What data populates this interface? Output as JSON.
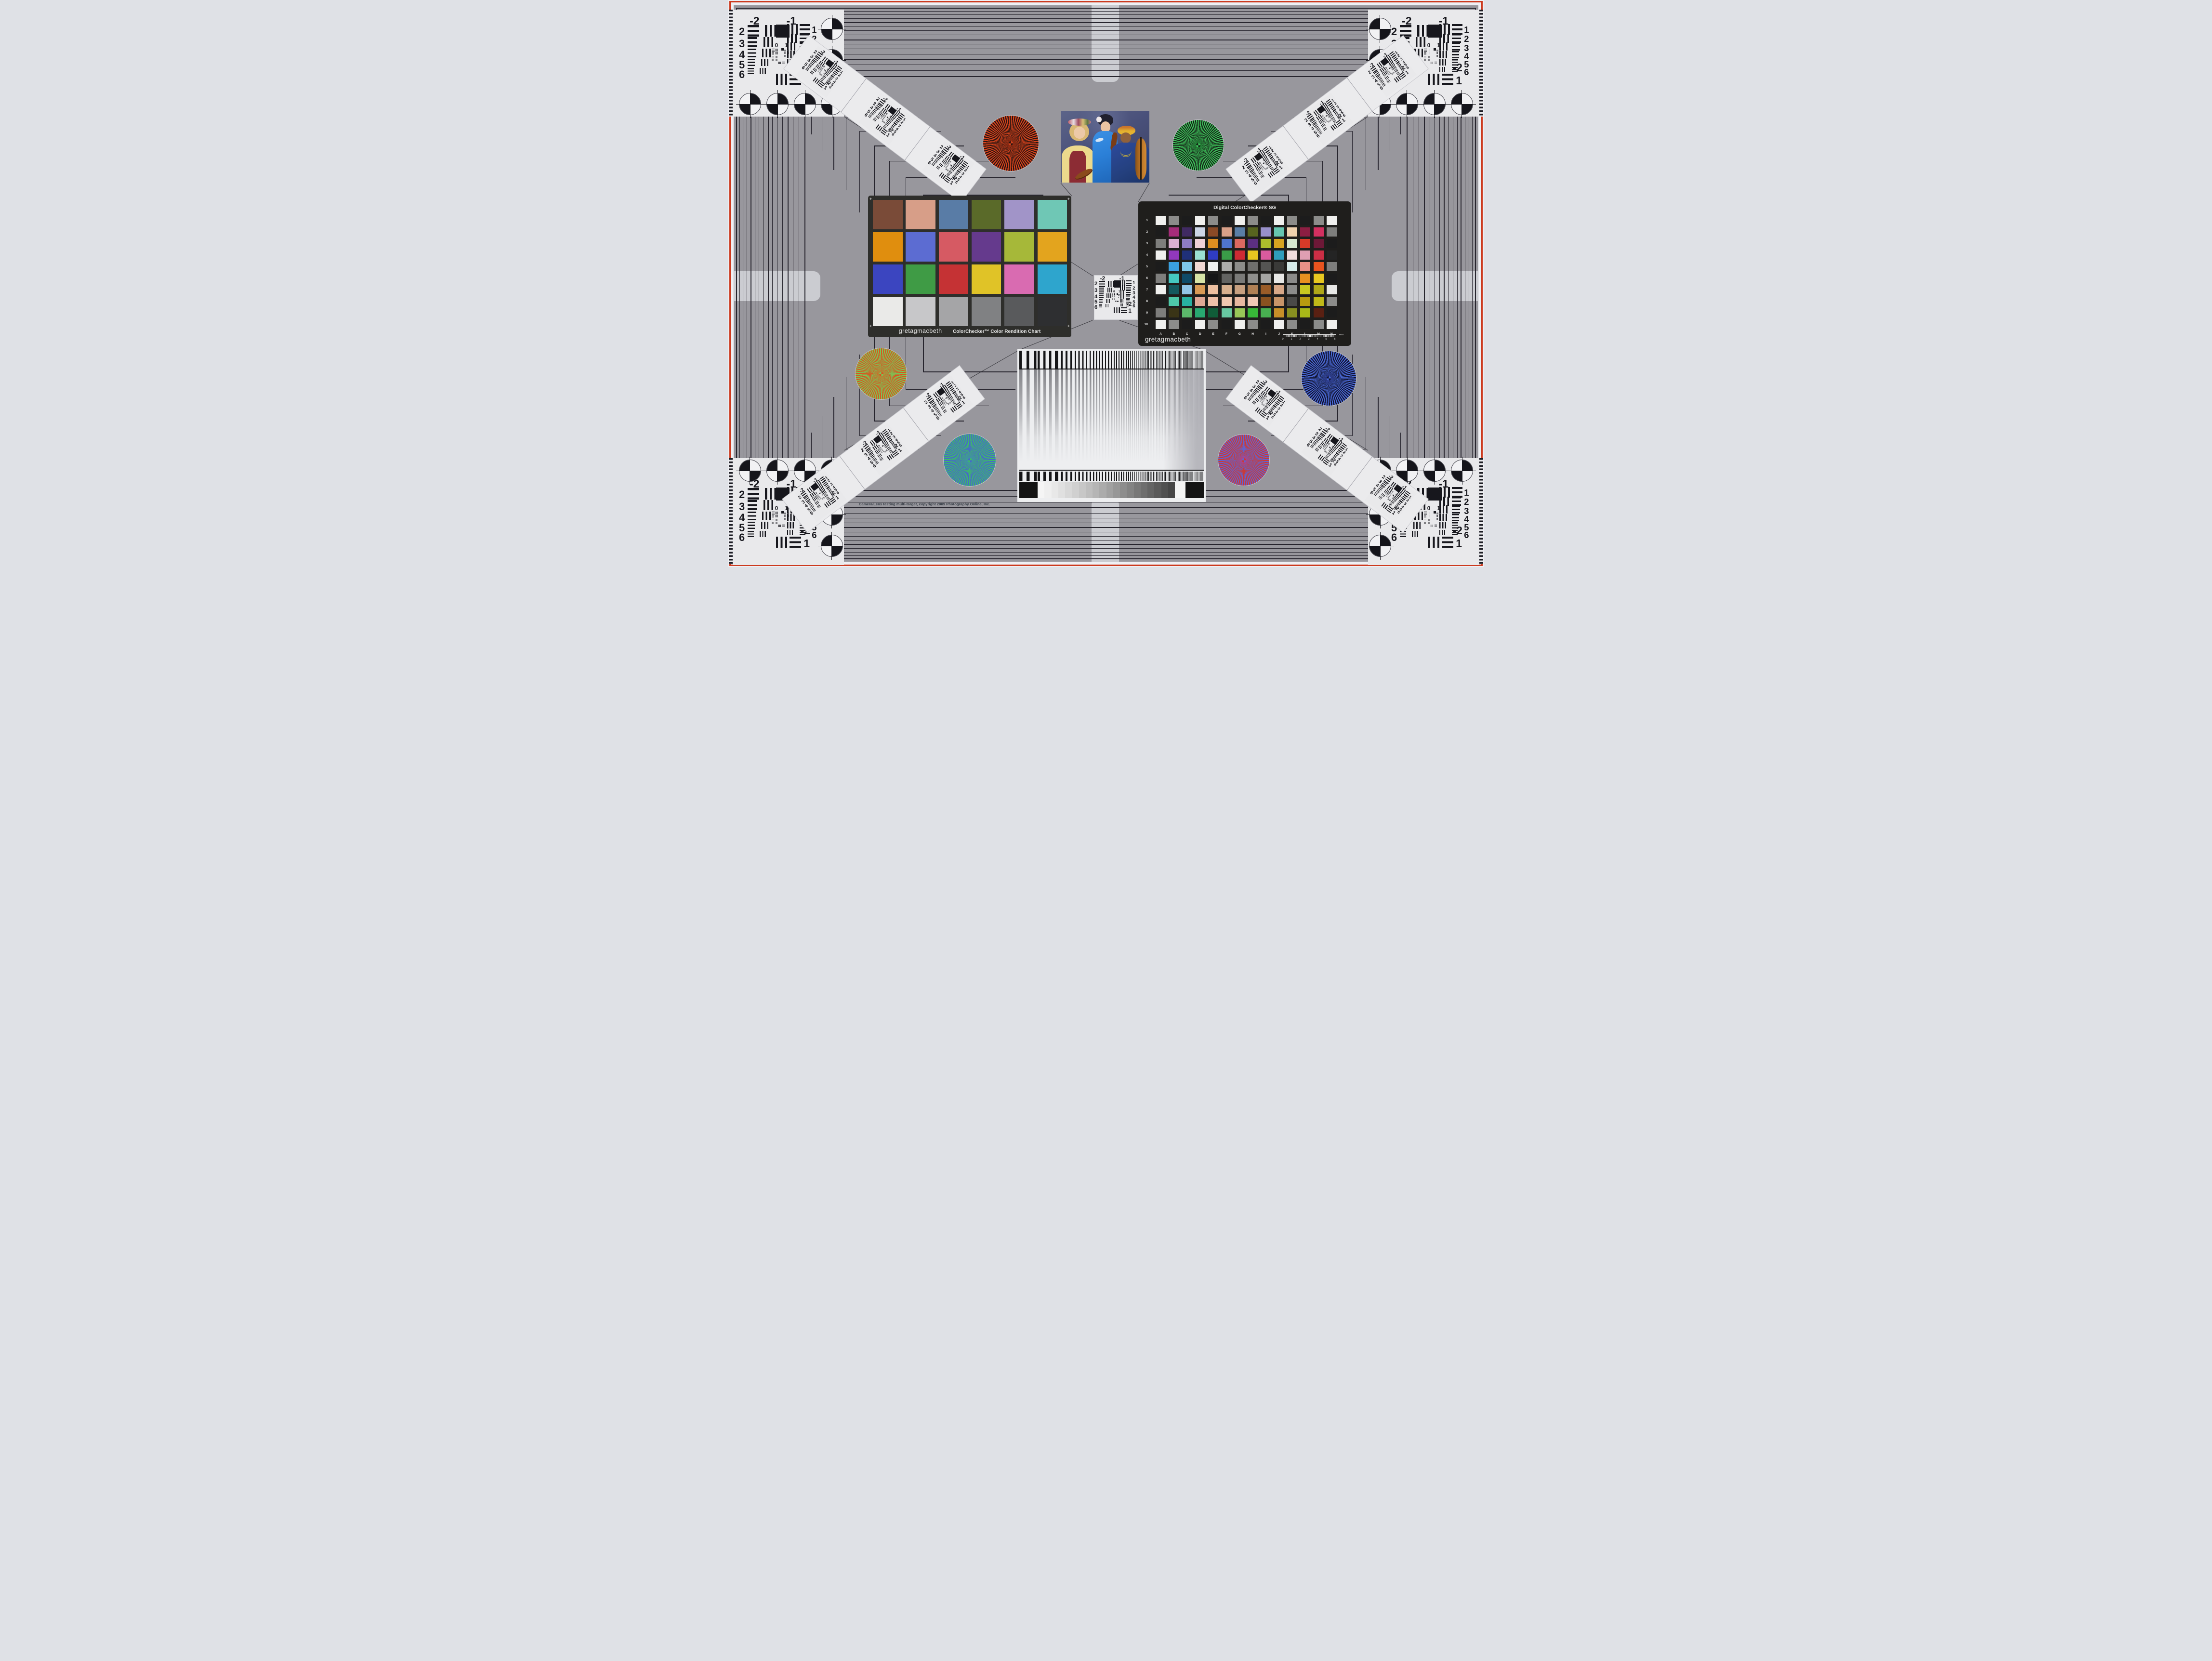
{
  "meta": {
    "copyright": "Camera/Lens testing multi-target, copyright 2009 Photography Online, Inc."
  },
  "frame": {
    "red_border": "#cc3a1f",
    "field_gray": "#98979d",
    "line_color": "#27252e",
    "edge_bar": "#cbccd1",
    "panel_white": "#e9e9eb"
  },
  "usaf": {
    "top_left": "-2",
    "top_right": "-1",
    "left_rows": [
      "2",
      "3",
      "4",
      "5",
      "6"
    ],
    "right_rows": [
      "1",
      "2",
      "3",
      "4",
      "5",
      "6"
    ],
    "bottom_right_top": "-2",
    "bottom_right_bottom": "1",
    "inner": [
      "0",
      "1"
    ]
  },
  "colorchecker": {
    "brand": "gretagmacbeth",
    "title": "ColorChecker™ Color Rendition Chart",
    "corner_mark": "+",
    "patches": [
      "#7a4b38",
      "#d79e88",
      "#597ca6",
      "#5a6a29",
      "#a194c8",
      "#6fc7b5",
      "#e08e0e",
      "#5c6cd2",
      "#d65a63",
      "#653a8d",
      "#a6b839",
      "#e3a41e",
      "#3b45c0",
      "#3f9b45",
      "#c53234",
      "#e0c327",
      "#d96bb1",
      "#2ea5cd",
      "#eaeae8",
      "#c7c7c9",
      "#a5a5a7",
      "#808183",
      "#595a5c",
      "#2e2f31"
    ]
  },
  "sg": {
    "title": "Digital ColorChecker® SG",
    "brand": "gretagmacbeth",
    "row_labels": [
      "1",
      "2",
      "3",
      "4",
      "5",
      "6",
      "7",
      "8",
      "9",
      "10"
    ],
    "col_labels": [
      "A",
      "B",
      "C",
      "D",
      "E",
      "F",
      "G",
      "H",
      "I",
      "J",
      "K",
      "L",
      "M",
      "N"
    ],
    "ruler": {
      "values": [
        "0",
        "1",
        "2",
        "3",
        "4",
        "5",
        "6"
      ],
      "unit": "mm"
    },
    "patches": [
      [
        "#f0f0ee",
        "#8c8c8a",
        "#1c1c1c",
        "#f0f0ee",
        "#8c8c8a",
        "#1c1c1c",
        "#f0f0ee",
        "#8c8c8a",
        "#1c1c1c",
        "#f0f0ee",
        "#8c8c8a",
        "#1c1c1c",
        "#8c8c8a",
        "#f0f0ee"
      ],
      [
        "#1c1c1c",
        "#a62c7a",
        "#402a62",
        "#ccd5e6",
        "#8a4a26",
        "#d8a088",
        "#5a7ea6",
        "#57641f",
        "#9890ca",
        "#66c6b0",
        "#efd2ae",
        "#8c1e42",
        "#d23060",
        "#7e7e7c"
      ],
      [
        "#7e7e7c",
        "#dcb0d2",
        "#8d7cc2",
        "#f0d0d8",
        "#de8f20",
        "#4f74ce",
        "#dc6860",
        "#5c2f80",
        "#adbd2c",
        "#d8a420",
        "#d8e8d0",
        "#d83a28",
        "#6d1837",
        "#1c1c1c"
      ],
      [
        "#f0f0ee",
        "#9238bc",
        "#1f3078",
        "#9adfd2",
        "#2f3cc4",
        "#3a9c48",
        "#ce2b33",
        "#e6c720",
        "#d95b9e",
        "#2f9dbc",
        "#efdcdc",
        "#df9fb2",
        "#cb2e45",
        "#242424"
      ],
      [
        "#1c1c1c",
        "#3aa0e0",
        "#7ec6e8",
        "#f2d8d2",
        "#f0f0ee",
        "#adadab",
        "#8c8c8a",
        "#6f6f6d",
        "#555553",
        "#3a3a38",
        "#d8ecea",
        "#e89086",
        "#e8541f",
        "#7e7e7c"
      ],
      [
        "#7e7e7c",
        "#45c8c0",
        "#0f4a68",
        "#d8e4a6",
        "#161616",
        "#636361",
        "#7a7a78",
        "#8f8f8d",
        "#a5a5a3",
        "#e8e8e6",
        "#8c8c8a",
        "#e89020",
        "#e8c820",
        "#1c1c1c"
      ],
      [
        "#f0f0ee",
        "#14595e",
        "#92c4e6",
        "#d89a55",
        "#eec0a0",
        "#d8b08e",
        "#c8a080",
        "#b08055",
        "#9a5c28",
        "#d8a888",
        "#8c8c8a",
        "#c8c820",
        "#b0a818",
        "#e8e8e6"
      ],
      [
        "#1c1c1c",
        "#4ec8a8",
        "#28b0a0",
        "#e0a896",
        "#eec0a8",
        "#f0c8b0",
        "#e8b8a0",
        "#f0c8b6",
        "#8a5220",
        "#c89468",
        "#4a4a48",
        "#b89a10",
        "#c0b818",
        "#8c8c8a"
      ],
      [
        "#7e7e7c",
        "#3a3416",
        "#5cb86a",
        "#28a870",
        "#105c38",
        "#68c8a0",
        "#98c858",
        "#38b838",
        "#48b050",
        "#c89028",
        "#889020",
        "#a8b818",
        "#5a2012",
        "#1c1c1c"
      ],
      [
        "#f0f0ee",
        "#8c8c8a",
        "#1c1c1c",
        "#f0f0ee",
        "#8c8c8a",
        "#1c1c1c",
        "#f0f0ee",
        "#8c8c8a",
        "#1c1c1c",
        "#f0f0ee",
        "#8c8c8a",
        "#1c1c1c",
        "#8c8c8a",
        "#f0f0ee"
      ]
    ]
  },
  "stars": [
    {
      "name": "star-red-black",
      "a": "#d7431d",
      "b": "#2a1410",
      "center": "#8c2a12"
    },
    {
      "name": "star-green-black",
      "a": "#3fc45c",
      "b": "#132015",
      "center": "#1f7a32"
    },
    {
      "name": "star-red-green",
      "a": "#d85420",
      "b": "#78c858",
      "center": "#b98233"
    },
    {
      "name": "star-blue-black",
      "a": "#4a69d6",
      "b": "#10122e",
      "center": "#2c3a8a"
    },
    {
      "name": "star-green-blue",
      "a": "#3dbb68",
      "b": "#4766cc",
      "center": "#3f97a0"
    },
    {
      "name": "star-red-blue",
      "a": "#cc3a33",
      "b": "#6063d0",
      "center": "#aa4490"
    }
  ],
  "sweep": {
    "wedge_steps": [
      "#f5f5f5",
      "#efefef",
      "#e8e8e8",
      "#e0e0e0",
      "#d8d8d8",
      "#d0d0d0",
      "#c7c7c7",
      "#bebebe",
      "#b5b5b5",
      "#ababab",
      "#a1a1a1",
      "#979797",
      "#8d8d8d",
      "#838383",
      "#787878",
      "#6e6e6e",
      "#646464",
      "#5a5a5a",
      "#505050",
      "#464646"
    ]
  },
  "photo": {
    "background": "#49507a",
    "skin_light": "#ecc9a8",
    "skin_mid": "#eac3a2",
    "skin_dark": "#8f613c",
    "blouse_yellow": "#ecd98c",
    "vest_red": "#8c2c34",
    "kimono_blue": "#2b80d8",
    "robe_blue": "#2d4a9c",
    "turban_yellow": "#e5b22f",
    "wood_brown": "#b97326"
  }
}
